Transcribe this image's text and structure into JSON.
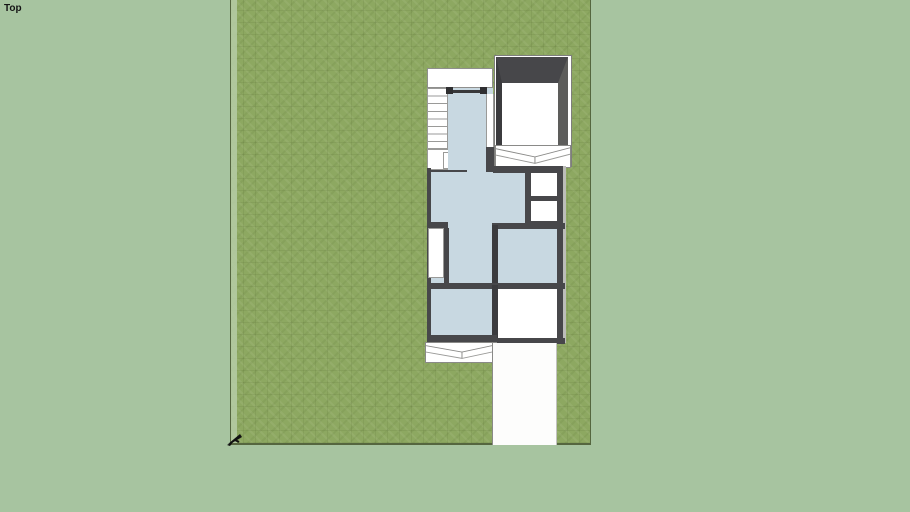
{
  "viewport": {
    "view_label": "Top",
    "colors": {
      "background": "#a7c4a0",
      "grass": "#8da861",
      "grass_edge_strip": "#b6cda7",
      "lot_border": "#55663f",
      "wall_dark": "#47474a",
      "wall_darker": "#3b3b3e",
      "wall_light": "#5d5d5b",
      "floor_blue": "#c8d8e1",
      "white": "#ffffff",
      "line_gray": "#8a8a88",
      "marker_black": "#111111"
    }
  }
}
